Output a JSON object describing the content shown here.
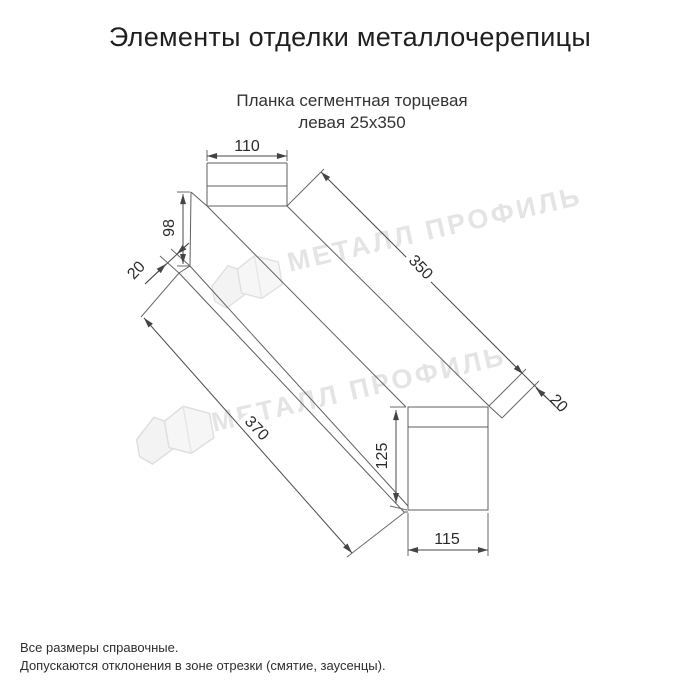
{
  "page": {
    "title": "Элементы отделки металлочерепицы",
    "subtitle_line1": "Планка сегментная торцевая",
    "subtitle_line2": "левая 25х350"
  },
  "diagram": {
    "product": "Планка сегментная торцевая левая 25х350",
    "dimensions": {
      "top_flange_width": "110",
      "left_face_height": "98",
      "left_bottom_flap": "20",
      "bottom_edge_length": "370",
      "top_edge_length": "350",
      "end_flap": "20",
      "right_face_height": "125",
      "right_face_width": "115"
    }
  },
  "watermark": {
    "text": "МЕТАЛЛ ПРОФИЛЬ"
  },
  "footer": {
    "line1": "Все размеры справочные.",
    "line2": "Допускаются отклонения в зоне отрезки (смятие, заусенцы)."
  },
  "colors": {
    "drawing_line": "#5f5f5f",
    "dimension_text": "#2b2b2b",
    "title_text": "#1f1f1f",
    "watermark": "#e4e4e4",
    "background": "#ffffff"
  }
}
